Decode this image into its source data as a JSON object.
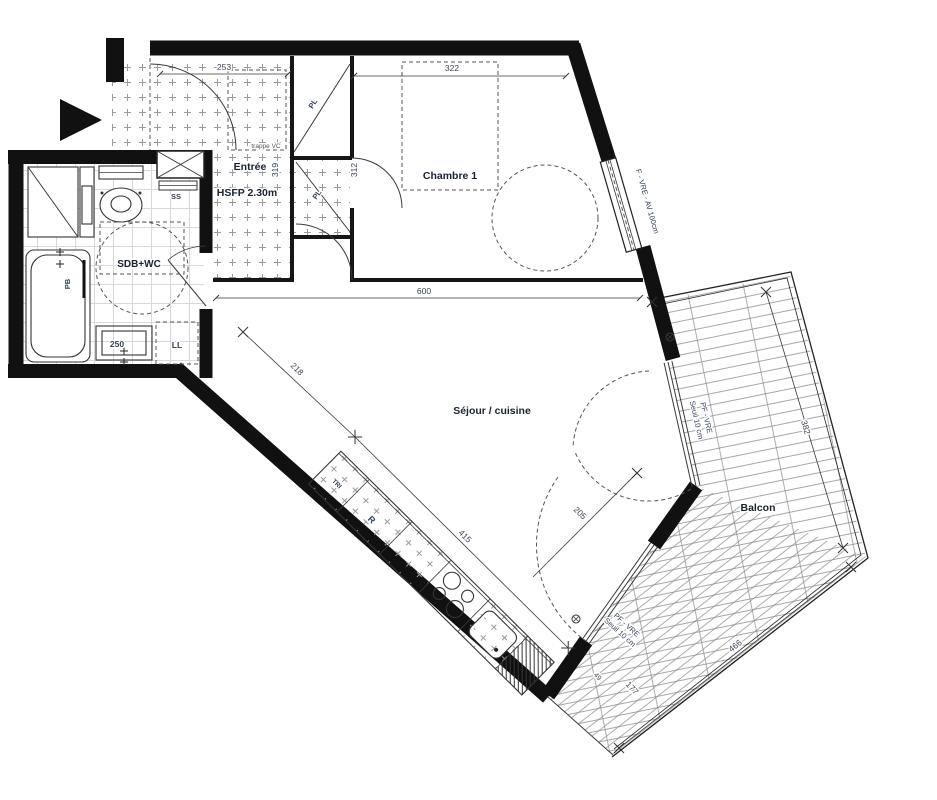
{
  "plan": {
    "rooms": {
      "entree": "Entrée",
      "entree_height": "HSFP 2.30m",
      "chambre": "Chambre 1",
      "sdb": "SDB+WC",
      "sejour": "Séjour / cuisine",
      "balcon": "Balcon"
    },
    "fixtures": {
      "ss": "SS",
      "pb": "PB",
      "ll": "LL",
      "vanity_width": "250",
      "pl_upper": "PL",
      "pl_lower": "PL",
      "fridge": "R",
      "tri": "TRI",
      "trappe": "trappe VC"
    },
    "openings": {
      "chambre_window": "F - VRE - AV 100cm",
      "balcony_door_right_l1": "PF - VRE",
      "balcony_door_right_l2": "Seuil 10 cm",
      "balcony_door_bottom_l1": "PF - VRE",
      "balcony_door_bottom_l2": "Seuil 10 cm"
    },
    "dims": {
      "entree_width": "253",
      "entree_depth": "319",
      "hall_depth": "312",
      "chambre_width": "322",
      "sejour_width": "600",
      "sejour_diag": "218",
      "kitchen_length": "415",
      "balcony_door": "205",
      "balcony_length": "382",
      "balcony_edge": "466",
      "balcony_door_bottom": "177",
      "balcony_small": "49"
    },
    "colors": {
      "wall": "#111111",
      "line": "#3a3a3a",
      "pattern": "#999999",
      "room_label": "#1a2230",
      "annotation": "#35425c",
      "dim": "#3c4454"
    }
  }
}
